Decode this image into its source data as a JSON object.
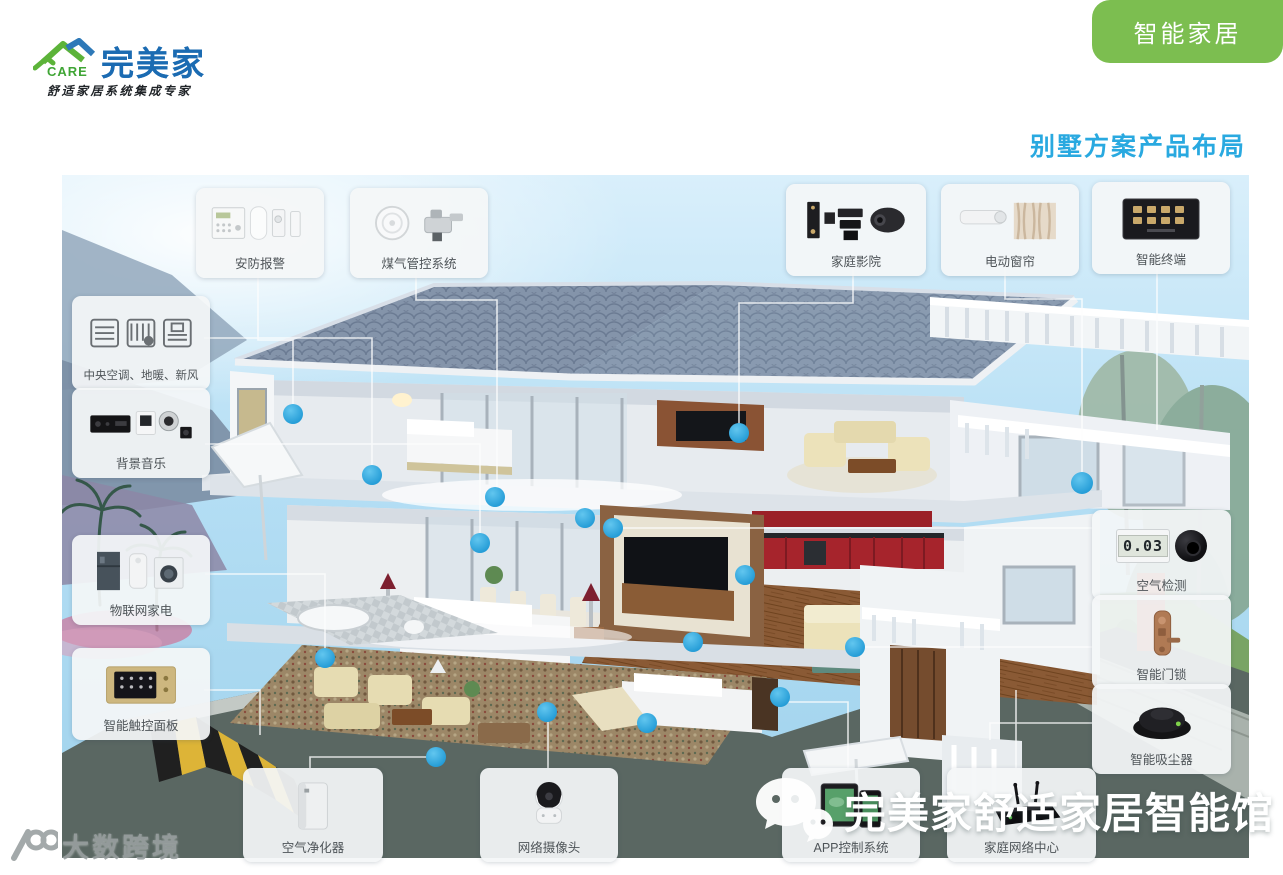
{
  "header": {
    "logo": {
      "icon": "house-roof-icon",
      "care": "CARE",
      "brand": "完美家",
      "tagline": "舒适家居系统集成专家"
    },
    "badge": "智能家居",
    "page_title": "别墅方案产品布局"
  },
  "callouts": [
    {
      "id": "security-alarm",
      "label": "安防报警"
    },
    {
      "id": "gas-control",
      "label": "煤气管控系统"
    },
    {
      "id": "home-theater",
      "label": "家庭影院"
    },
    {
      "id": "electric-curtain",
      "label": "电动窗帘"
    },
    {
      "id": "smart-terminal",
      "label": "智能终端"
    },
    {
      "id": "hvac",
      "label": "中央空调、地暖、新风"
    },
    {
      "id": "background-music",
      "label": "背景音乐"
    },
    {
      "id": "iot-appliances",
      "label": "物联网家电"
    },
    {
      "id": "touch-panel",
      "label": "智能触控面板"
    },
    {
      "id": "air-detection",
      "label": "空气检测"
    },
    {
      "id": "smart-door-lock",
      "label": "智能门锁"
    },
    {
      "id": "robot-vacuum",
      "label": "智能吸尘器"
    },
    {
      "id": "air-purifier",
      "label": "空气净化器"
    },
    {
      "id": "ip-camera",
      "label": "网络摄像头"
    },
    {
      "id": "app-control",
      "label": "APP控制系统"
    },
    {
      "id": "home-network",
      "label": "家庭网络中心"
    }
  ],
  "air_monitor_reading": "0.03",
  "watermarks": {
    "wechat_text": "完美家舒适家居智能馆",
    "corner_text": "大数跨境"
  },
  "colors": {
    "accent_dot_blue": "#29abe2",
    "badge_green": "#7cbe50",
    "brand_blue": "#1b6bb2",
    "brand_green": "#5cb339",
    "title_cyan": "#29a9e0"
  }
}
